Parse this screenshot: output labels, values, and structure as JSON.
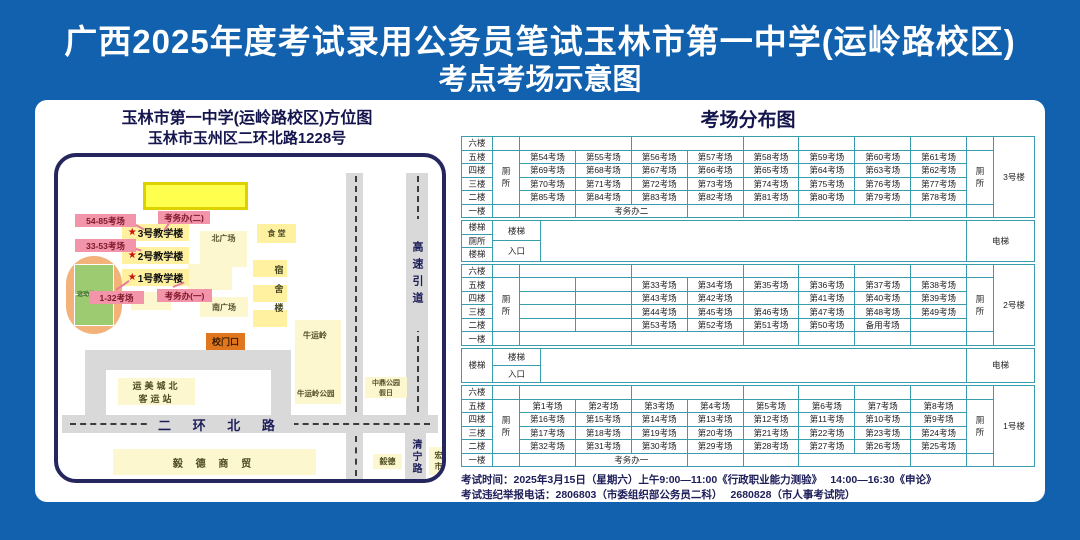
{
  "colors": {
    "background": "#1161ae",
    "panel": "#ffffff",
    "table_border": "#3a9dad",
    "navy_text": "#15154e",
    "pink_badge": "#f295ab",
    "pink_text": "#7d1526",
    "yellow_bright": "#ffff4d",
    "yellow_mid": "#fff1a0",
    "yellow_pale": "#fdf7cf",
    "gate_orange": "#e0771e",
    "road_gray": "#d9d9d9",
    "field_green": "#9ccb72",
    "track_orange": "#f3b27a",
    "star_red": "#cc1111"
  },
  "title": {
    "line1": "广西2025年度考试录用公务员笔试玉林市第一中学(运岭路校区)",
    "line2": "考点考场示意图"
  },
  "map": {
    "header1": "玉林市第一中学(运岭路校区)方位图",
    "header2": "玉林市玉州区二环北路1228号",
    "labels": {
      "exam_office2": "考务办(二)",
      "exam_office1": "考务办(一)",
      "bld3": "3号教学楼",
      "bld2": "2号教学楼",
      "bld1": "1号教学楼",
      "rooms_54_85": "54-85考场",
      "rooms_33_53": "33-53考场",
      "rooms_1_32": "1-32考场",
      "north_plaza": "北广场",
      "south_plaza": "南广场",
      "canteen": "食 堂",
      "dorm": "宿舍楼",
      "sports_field": "运动场",
      "gate": "校门口",
      "niuyunling": "牛运岭",
      "niuyunling_park": "牛运岭公园",
      "bus_station_l1": "运美城北",
      "bus_station_l2": "客运站",
      "erhuan_road": "二 环 北 路",
      "highway_ramp": "高速引道",
      "qingning_road": "清宁路",
      "zhongding_l1": "中鼎公园",
      "zhongding_l2": "假日",
      "yide_trade": "毅 德 商 贸",
      "yide_small": "毅德",
      "hongjin_l1": "宏进",
      "hongjin_l2": "市场"
    }
  },
  "distribution": {
    "title": "考场分布图",
    "floors": [
      "六楼",
      "五楼",
      "四楼",
      "三楼",
      "二楼",
      "一楼"
    ],
    "blocks": [
      {
        "type": "building",
        "name": "3号楼",
        "toilet": "厕所",
        "rows": [
          [
            [
              "",
              2
            ],
            [
              "",
              2
            ],
            [
              "",
              1
            ],
            [
              "",
              1
            ],
            [
              "",
              1
            ],
            [
              "",
              1
            ]
          ],
          [
            [
              "第54考场",
              1
            ],
            [
              "第55考场",
              1
            ],
            [
              "第56考场",
              1
            ],
            [
              "第57考场",
              1
            ],
            [
              "第58考场",
              1
            ],
            [
              "第59考场",
              1
            ],
            [
              "第60考场",
              1
            ],
            [
              "第61考场",
              1
            ]
          ],
          [
            [
              "第69考场",
              1
            ],
            [
              "第68考场",
              1
            ],
            [
              "第67考场",
              1
            ],
            [
              "第66考场",
              1
            ],
            [
              "第65考场",
              1
            ],
            [
              "第64考场",
              1
            ],
            [
              "第63考场",
              1
            ],
            [
              "第62考场",
              1
            ]
          ],
          [
            [
              "第70考场",
              1
            ],
            [
              "第71考场",
              1
            ],
            [
              "第72考场",
              1
            ],
            [
              "第73考场",
              1
            ],
            [
              "第74考场",
              1
            ],
            [
              "第75考场",
              1
            ],
            [
              "第76考场",
              1
            ],
            [
              "第77考场",
              1
            ]
          ],
          [
            [
              "第85考场",
              1
            ],
            [
              "第84考场",
              1
            ],
            [
              "第83考场",
              1
            ],
            [
              "第82考场",
              1
            ],
            [
              "第81考场",
              1
            ],
            [
              "第80考场",
              1
            ],
            [
              "第79考场",
              1
            ],
            [
              "第78考场",
              1
            ]
          ],
          [
            [
              "",
              1
            ],
            [
              "考务办二",
              2
            ],
            [
              "",
              1
            ],
            [
              "",
              1
            ],
            [
              "",
              2
            ],
            [
              "",
              1
            ]
          ]
        ]
      },
      {
        "type": "stairs",
        "left_labels": [
          "楼梯",
          "厕所",
          "楼梯"
        ],
        "stair": "楼梯",
        "entrance": "入口",
        "elevator": "电梯"
      },
      {
        "type": "building",
        "name": "2号楼",
        "toilet": "厕所",
        "rows": [
          [
            [
              "",
              2
            ],
            [
              "",
              2
            ],
            [
              "",
              1
            ],
            [
              "",
              1
            ],
            [
              "",
              1
            ],
            [
              "",
              1
            ]
          ],
          [
            [
              "",
              1
            ],
            [
              "",
              1
            ],
            [
              "第33考场",
              1
            ],
            [
              "第34考场",
              1
            ],
            [
              "第35考场",
              1
            ],
            [
              "第36考场",
              1
            ],
            [
              "第37考场",
              1
            ],
            [
              "第38考场",
              1
            ]
          ],
          [
            [
              "",
              1
            ],
            [
              "",
              1
            ],
            [
              "第43考场",
              1
            ],
            [
              "第42考场",
              1
            ],
            [
              "",
              1
            ],
            [
              "第41考场",
              1
            ],
            [
              "第40考场",
              1
            ],
            [
              "第39考场",
              1
            ]
          ],
          [
            [
              "",
              1
            ],
            [
              "",
              1
            ],
            [
              "第44考场",
              1
            ],
            [
              "第45考场",
              1
            ],
            [
              "第46考场",
              1
            ],
            [
              "第47考场",
              1
            ],
            [
              "第48考场",
              1
            ],
            [
              "第49考场",
              1
            ]
          ],
          [
            [
              "",
              1
            ],
            [
              "",
              1
            ],
            [
              "第53考场",
              1
            ],
            [
              "第52考场",
              1
            ],
            [
              "第51考场",
              1
            ],
            [
              "第50考场",
              1
            ],
            [
              "备用考场",
              1
            ],
            [
              "",
              1
            ]
          ],
          [
            [
              "",
              2
            ],
            [
              "",
              2
            ],
            [
              "",
              1
            ],
            [
              "",
              1
            ],
            [
              "",
              1
            ],
            [
              "",
              1
            ]
          ]
        ]
      },
      {
        "type": "stairs",
        "left_labels": [
          "楼梯"
        ],
        "stair": "楼梯",
        "entrance": "入口",
        "elevator": "电梯"
      },
      {
        "type": "building",
        "name": "1号楼",
        "toilet": "厕所",
        "rows": [
          [
            [
              "",
              2
            ],
            [
              "",
              2
            ],
            [
              "",
              1
            ],
            [
              "",
              1
            ],
            [
              "",
              1
            ],
            [
              "",
              1
            ]
          ],
          [
            [
              "第1考场",
              1
            ],
            [
              "第2考场",
              1
            ],
            [
              "第3考场",
              1
            ],
            [
              "第4考场",
              1
            ],
            [
              "第5考场",
              1
            ],
            [
              "第6考场",
              1
            ],
            [
              "第7考场",
              1
            ],
            [
              "第8考场",
              1
            ]
          ],
          [
            [
              "第16考场",
              1
            ],
            [
              "第15考场",
              1
            ],
            [
              "第14考场",
              1
            ],
            [
              "第13考场",
              1
            ],
            [
              "第12考场",
              1
            ],
            [
              "第11考场",
              1
            ],
            [
              "第10考场",
              1
            ],
            [
              "第9考场",
              1
            ]
          ],
          [
            [
              "第17考场",
              1
            ],
            [
              "第18考场",
              1
            ],
            [
              "第19考场",
              1
            ],
            [
              "第20考场",
              1
            ],
            [
              "第21考场",
              1
            ],
            [
              "第22考场",
              1
            ],
            [
              "第23考场",
              1
            ],
            [
              "第24考场",
              1
            ]
          ],
          [
            [
              "第32考场",
              1
            ],
            [
              "第31考场",
              1
            ],
            [
              "第30考场",
              1
            ],
            [
              "第29考场",
              1
            ],
            [
              "第28考场",
              1
            ],
            [
              "第27考场",
              1
            ],
            [
              "第26考场",
              1
            ],
            [
              "第25考场",
              1
            ]
          ],
          [
            [
              "",
              1
            ],
            [
              "考务办一",
              2
            ],
            [
              "",
              1
            ],
            [
              "",
              1
            ],
            [
              "",
              2
            ],
            [
              "",
              1
            ]
          ]
        ]
      }
    ]
  },
  "footer": {
    "line1": "考试时间：2025年3月15日（星期六）上午9:00—11:00《行政职业能力测验》　 14:00—16:30《申论》",
    "line2": "考试违纪举报电话：2806803（市委组织部公务员二科）　 2680828（市人事考试院）"
  }
}
